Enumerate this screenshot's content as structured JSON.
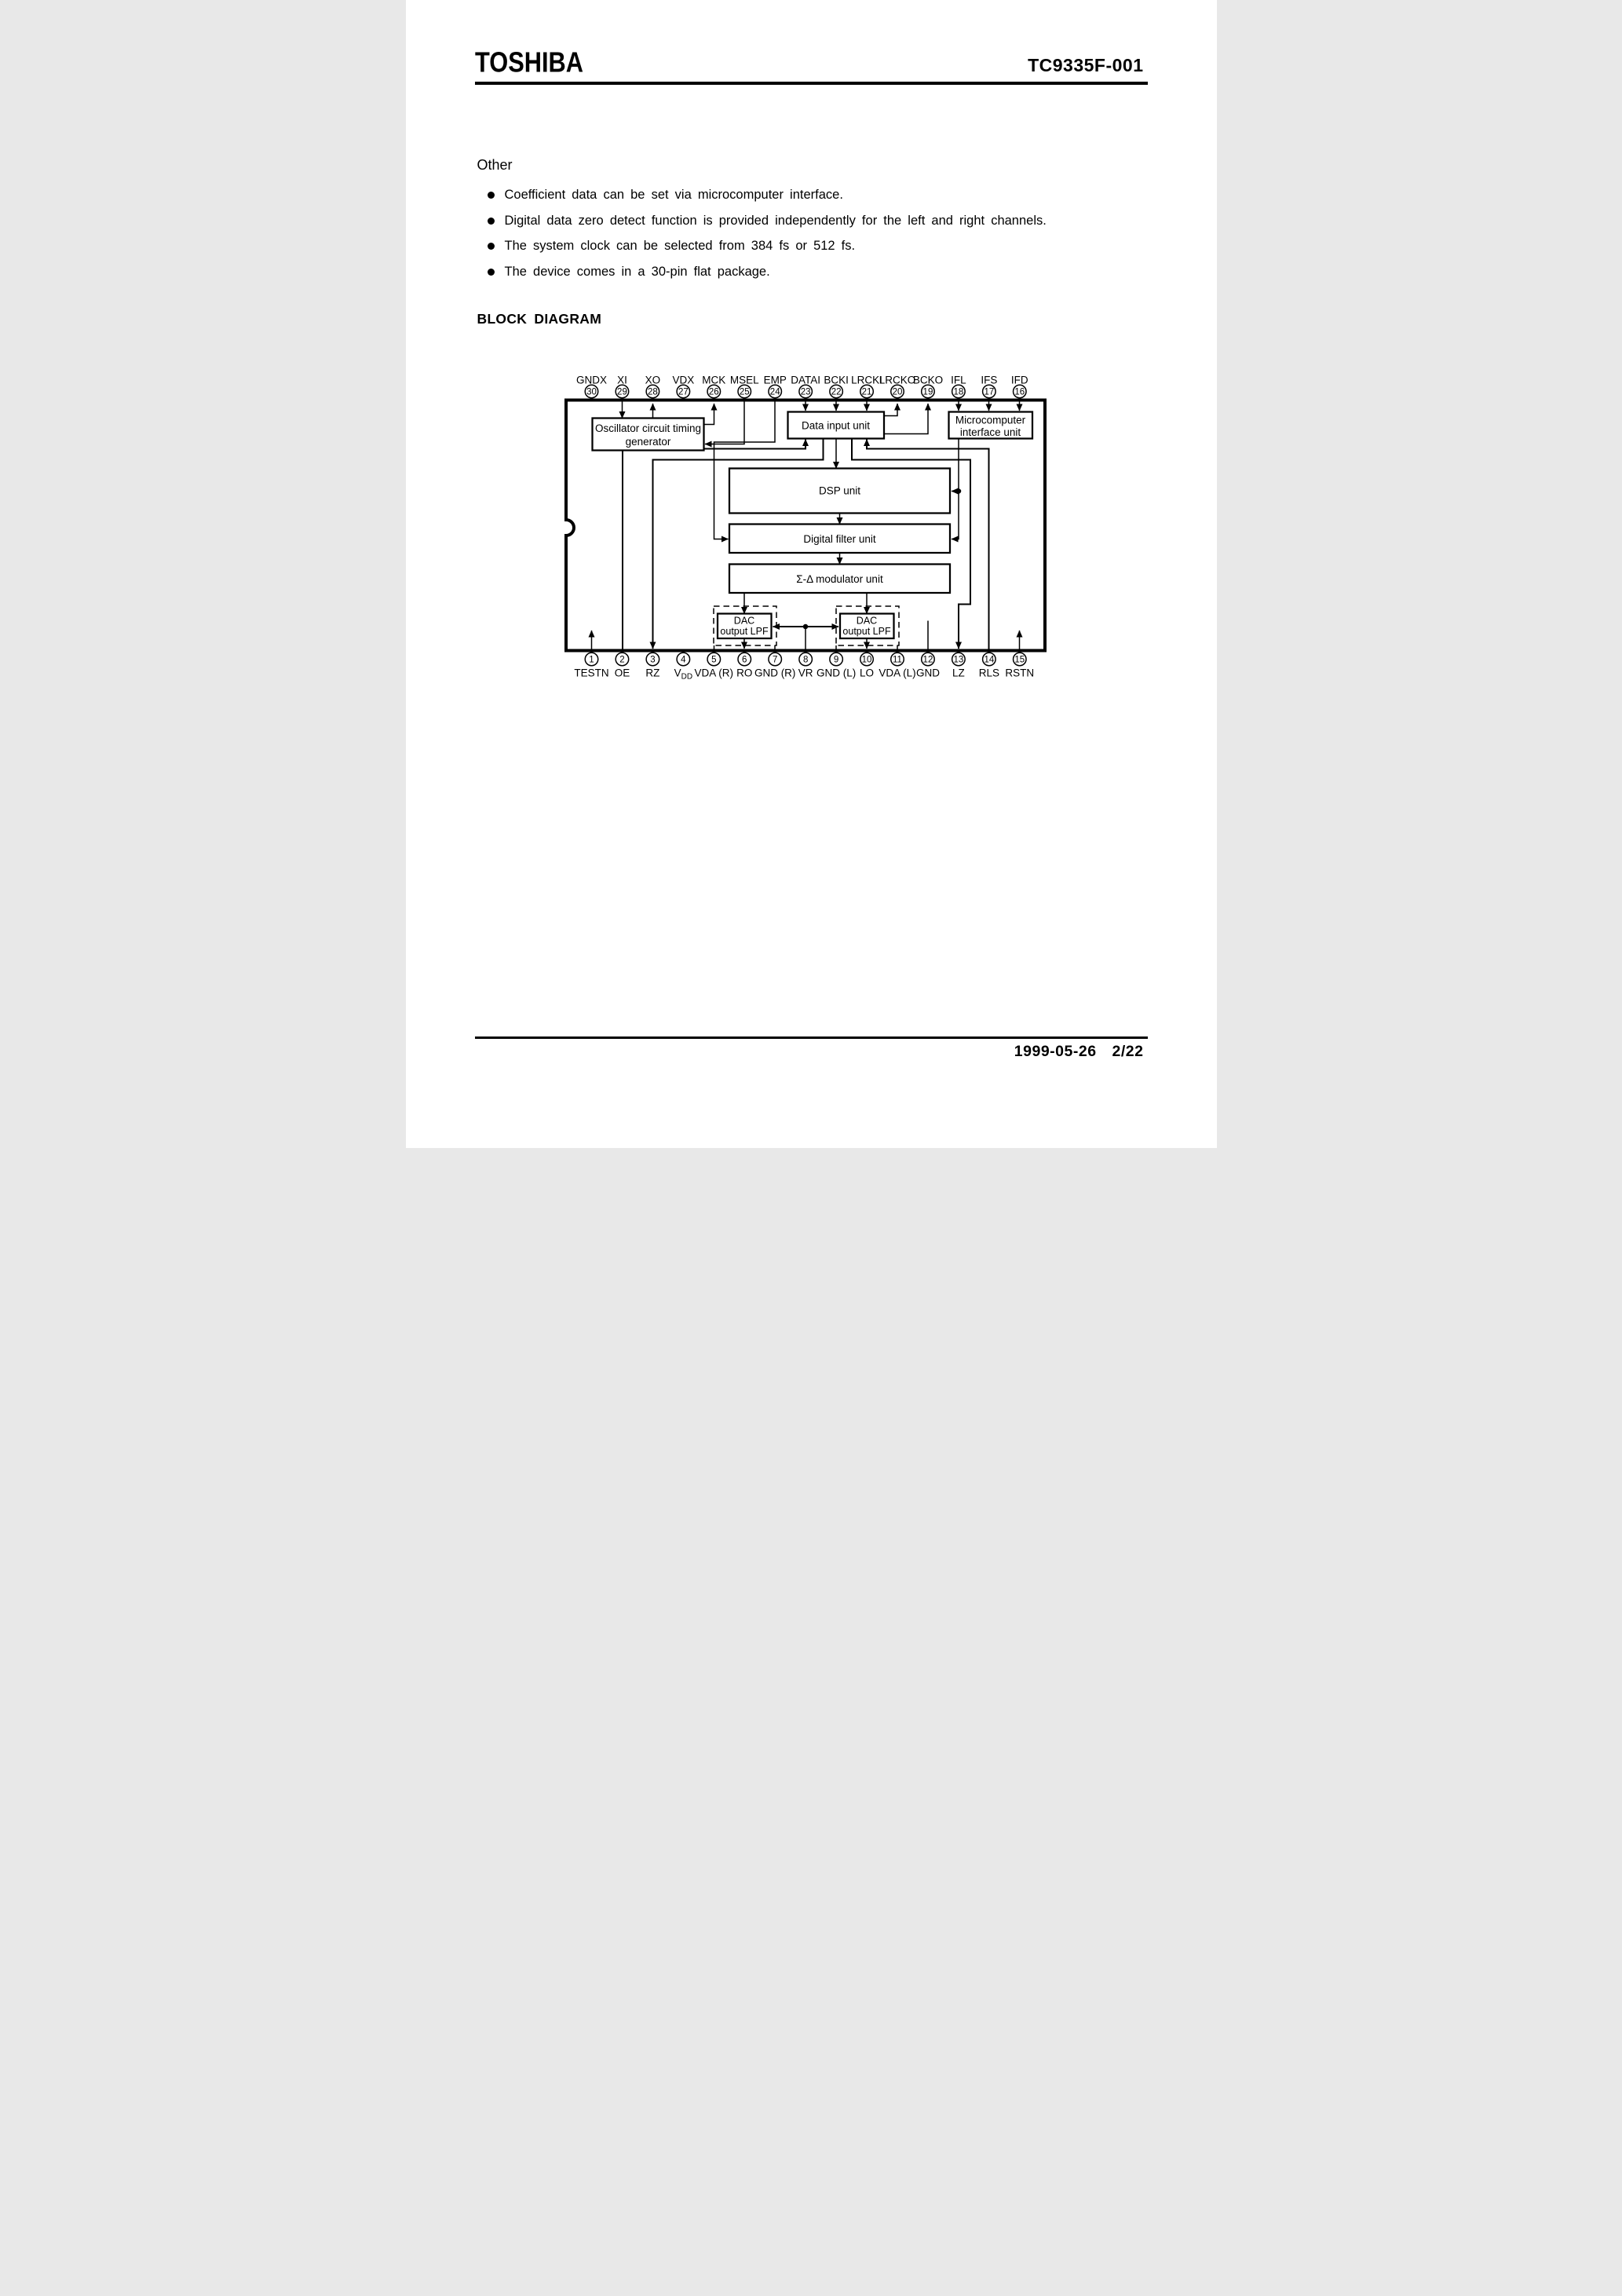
{
  "page": {
    "background": "#ffffff",
    "ink": "#000000"
  },
  "header": {
    "brand": "TOSHIBA",
    "part_number": "TC9335F-001"
  },
  "other": {
    "heading": "Other",
    "bullets": [
      "Coefficient data can be set via microcomputer interface.",
      "Digital data zero detect function is provided independently for the left and right channels.",
      "The system clock can be selected from 384 fs or 512 fs.",
      "The device comes in a 30-pin flat package."
    ]
  },
  "diagram": {
    "heading": "BLOCK DIAGRAM",
    "blocks": {
      "oscillator_line1": "Oscillator circuit timing",
      "oscillator_line2": "generator",
      "data_input": "Data input unit",
      "microcomputer_line1": "Microcomputer",
      "microcomputer_line2": "interface unit",
      "dsp": "DSP unit",
      "digital_filter": "Digital filter unit",
      "sigma_delta": "Σ-Δ modulator unit",
      "dac_line1": "DAC",
      "dac_line2": "output LPF"
    },
    "top_pins": [
      {
        "num": "30",
        "label": "GNDX"
      },
      {
        "num": "29",
        "label": "XI"
      },
      {
        "num": "28",
        "label": "XO"
      },
      {
        "num": "27",
        "label": "VDX"
      },
      {
        "num": "26",
        "label": "MCK"
      },
      {
        "num": "25",
        "label": "MSEL"
      },
      {
        "num": "24",
        "label": "EMP"
      },
      {
        "num": "23",
        "label": "DATAI"
      },
      {
        "num": "22",
        "label": "BCKI"
      },
      {
        "num": "21",
        "label": "LRCKI"
      },
      {
        "num": "20",
        "label": "LRCKO"
      },
      {
        "num": "19",
        "label": "BCKO"
      },
      {
        "num": "18",
        "label": "IFL"
      },
      {
        "num": "17",
        "label": "IFS"
      },
      {
        "num": "16",
        "label": "IFD"
      }
    ],
    "bottom_pins": [
      {
        "num": "1",
        "label": "TESTN"
      },
      {
        "num": "2",
        "label": "OE"
      },
      {
        "num": "3",
        "label": "RZ"
      },
      {
        "num": "4",
        "label": "V",
        "sub": "DD"
      },
      {
        "num": "5",
        "label": "VDA (R)"
      },
      {
        "num": "6",
        "label": "RO"
      },
      {
        "num": "7",
        "label": "GND (R)"
      },
      {
        "num": "8",
        "label": "VR"
      },
      {
        "num": "9",
        "label": "GND (L)"
      },
      {
        "num": "10",
        "label": "LO"
      },
      {
        "num": "11",
        "label": "VDA (L)"
      },
      {
        "num": "12",
        "label": "GND"
      },
      {
        "num": "13",
        "label": "LZ"
      },
      {
        "num": "14",
        "label": "RLS"
      },
      {
        "num": "15",
        "label": "RSTN"
      }
    ]
  },
  "footer": {
    "date": "1999-05-26",
    "page": "2/22"
  }
}
